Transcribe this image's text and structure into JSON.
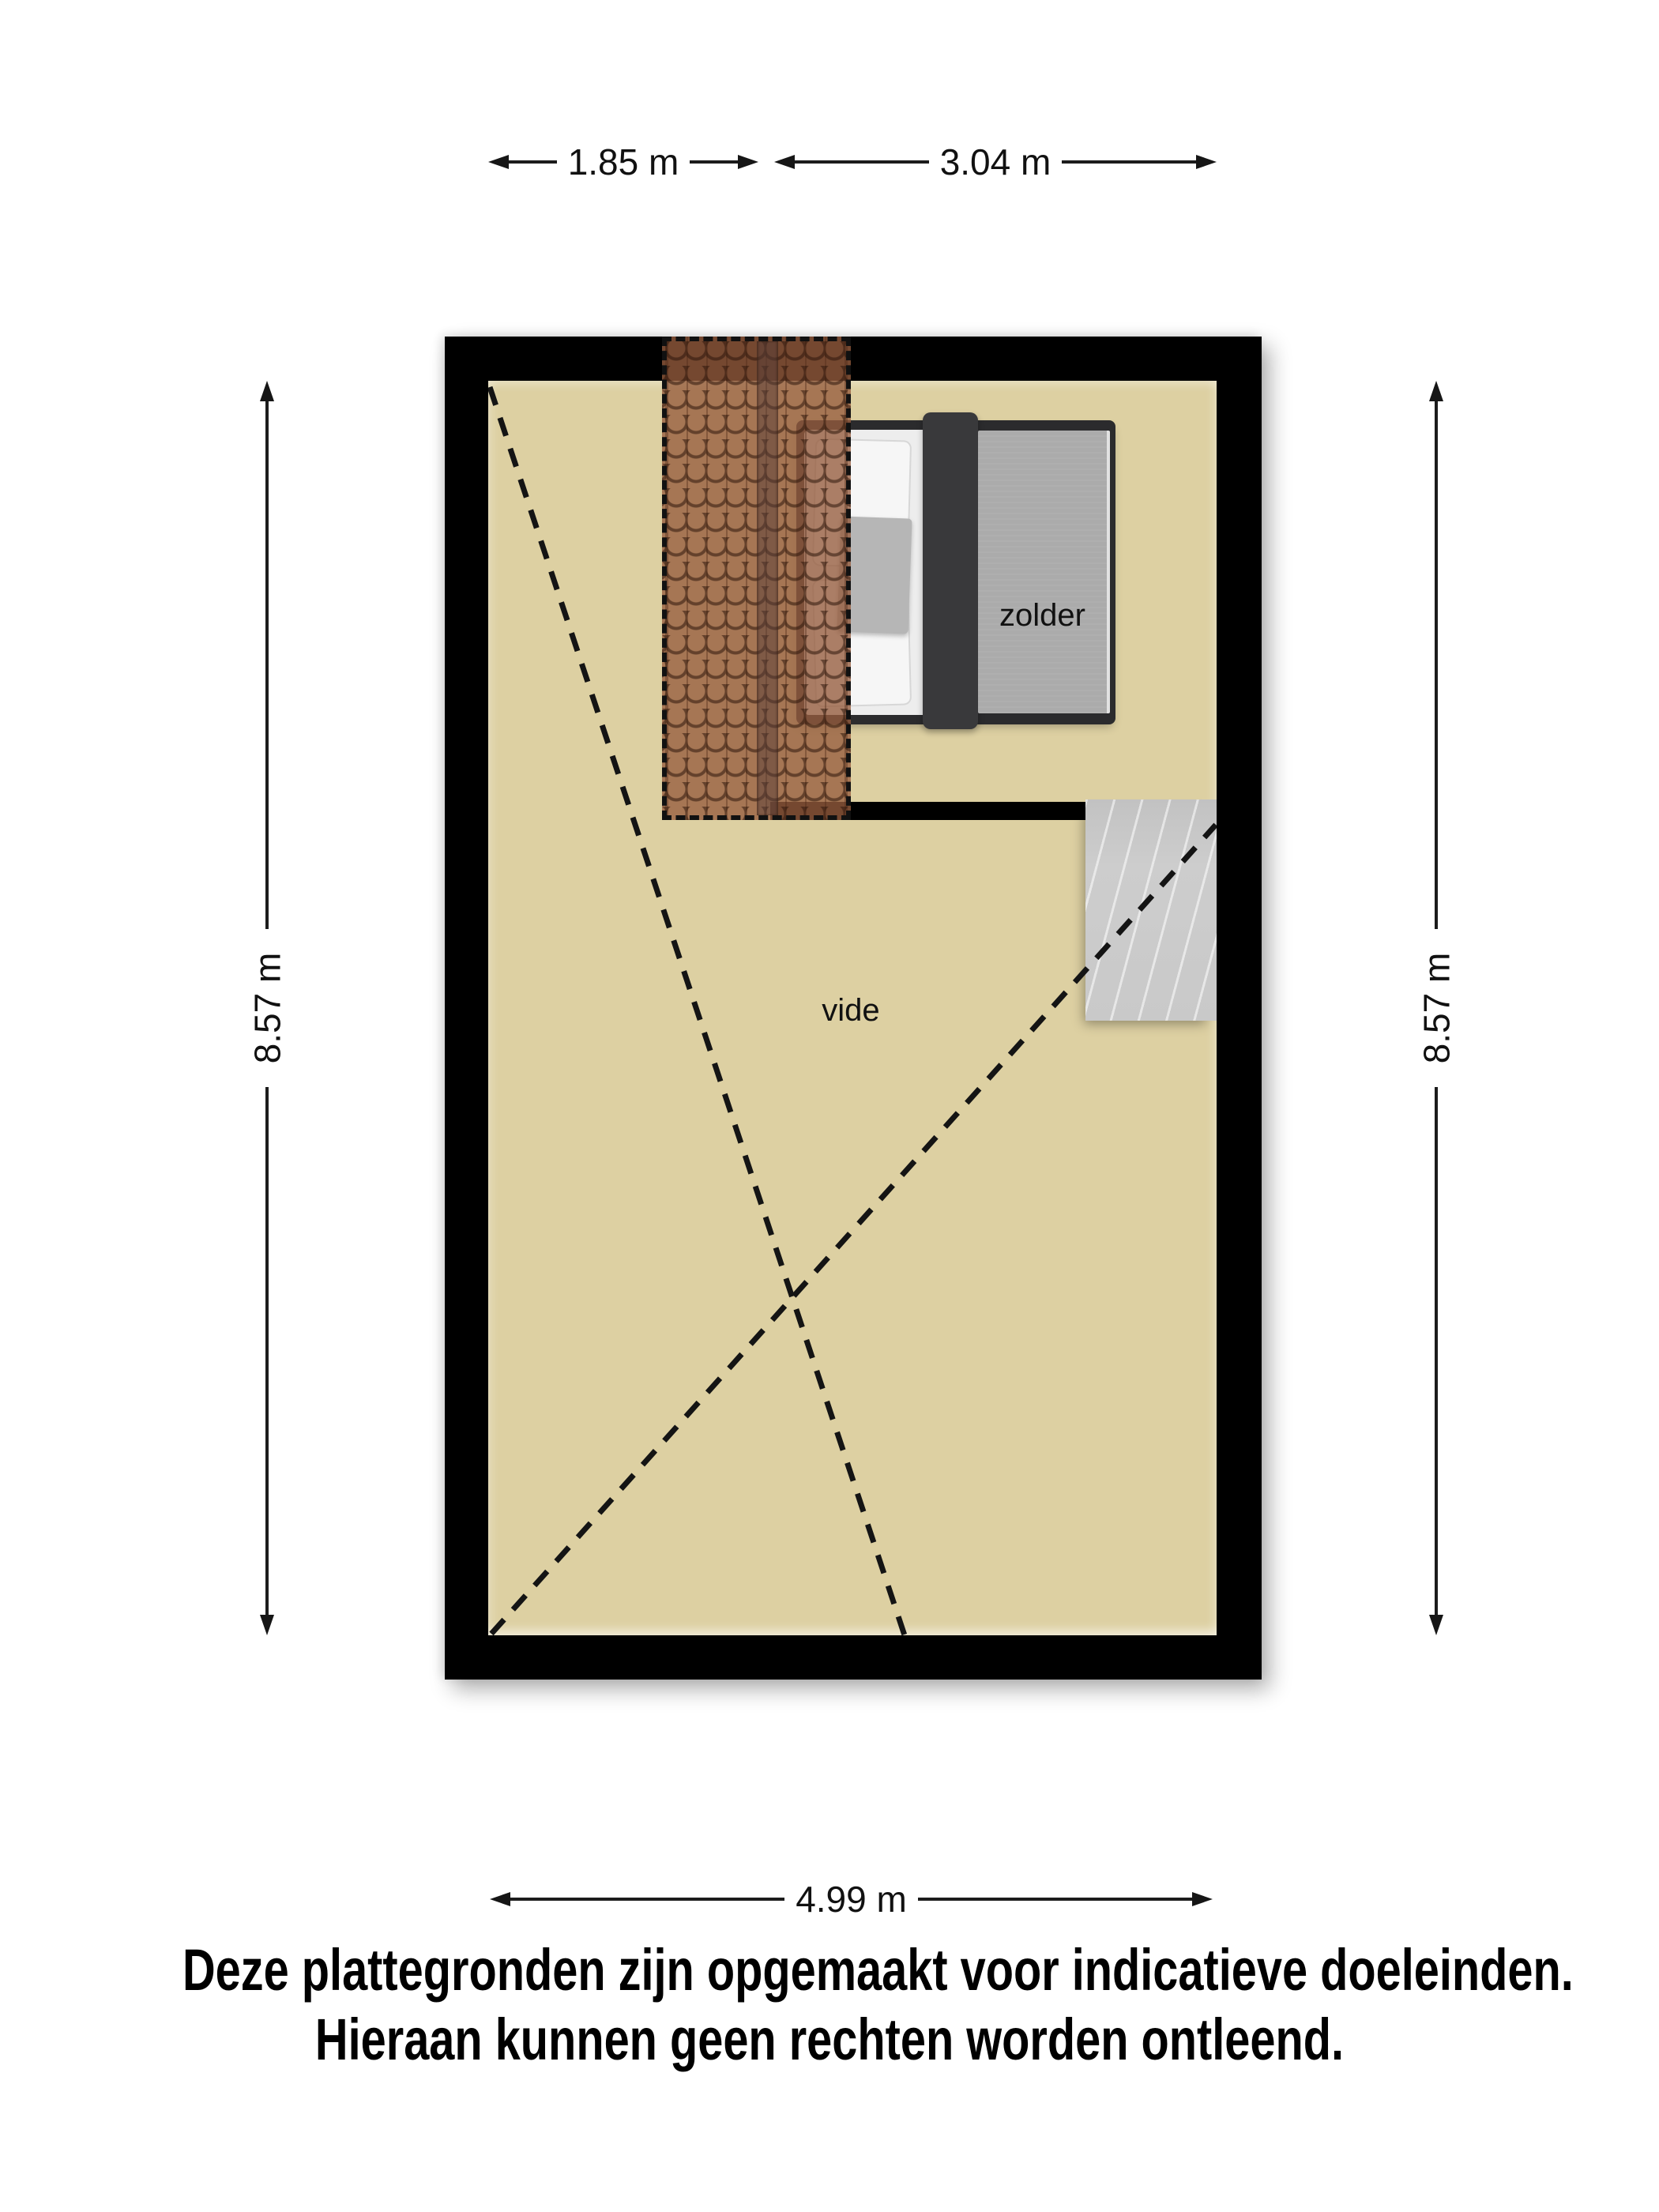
{
  "floorplan": {
    "rooms": {
      "attic_label": "zolder",
      "void_label": "vide"
    },
    "dimensions": {
      "top_left": "1.85 m",
      "top_right": "3.04 m",
      "left": "8.57 m",
      "right": "8.57 m",
      "bottom": "4.99 m"
    },
    "disclaimer": {
      "line1": "Deze plattegronden zijn opgemaakt voor indicatieve doeleinden.",
      "line2": "Hieraan kunnen geen rechten worden ontleend."
    },
    "colors": {
      "floor": "#ddd0a2",
      "wall": "#000000",
      "roof_tiles": "#965c3e",
      "stairs": "#c9c9c9",
      "bed_frame": "#2b2b2d",
      "bed_duvet_dark": "#39393b",
      "bed_duvet_gray": "#ababab",
      "bed_sheet": "#ededed"
    }
  }
}
